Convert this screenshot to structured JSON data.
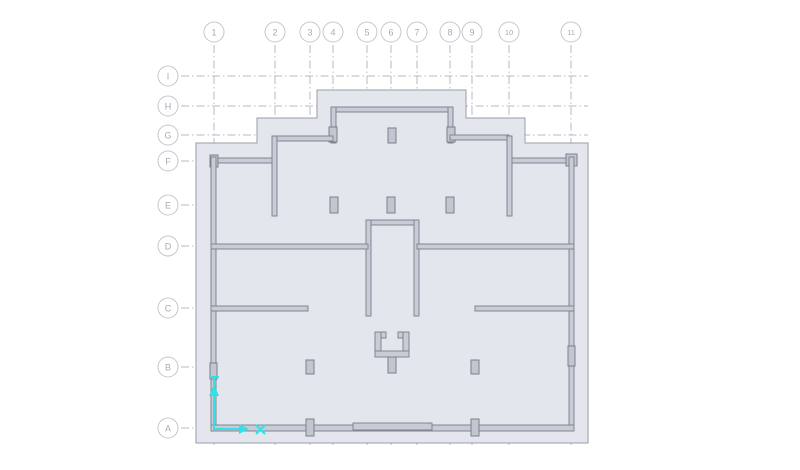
{
  "drawing": {
    "type": "structural-floor-plan",
    "grid": {
      "columns": [
        {
          "label": "1",
          "x": 214
        },
        {
          "label": "2",
          "x": 275
        },
        {
          "label": "3",
          "x": 310
        },
        {
          "label": "4",
          "x": 333
        },
        {
          "label": "5",
          "x": 367
        },
        {
          "label": "6",
          "x": 391
        },
        {
          "label": "7",
          "x": 417
        },
        {
          "label": "8",
          "x": 450
        },
        {
          "label": "9",
          "x": 472
        },
        {
          "label": "10",
          "x": 509
        },
        {
          "label": "11",
          "x": 571
        }
      ],
      "rows": [
        {
          "label": "I",
          "y": 76
        },
        {
          "label": "H",
          "y": 106
        },
        {
          "label": "G",
          "y": 135
        },
        {
          "label": "F",
          "y": 161
        },
        {
          "label": "E",
          "y": 205
        },
        {
          "label": "D",
          "y": 246
        },
        {
          "label": "C",
          "y": 308
        },
        {
          "label": "B",
          "y": 367
        },
        {
          "label": "A",
          "y": 428
        }
      ],
      "bubble_radius": 10,
      "column_bubble_y": 32,
      "row_bubble_x": 168,
      "v_line_top": 45,
      "v_line_bottom": 446,
      "h_line_left": 181,
      "h_line_right": 588
    },
    "colors": {
      "background": "#ffffff",
      "slab_fill": "#e4e6ed",
      "slab_edge": "#989daa",
      "wall_fill": "#c8ccd6",
      "wall_edge": "#80858f",
      "grid_line": "#b5b9c4",
      "bubble_edge": "#c4c7d0",
      "bubble_text": "#a8abb5",
      "highlight_cyan": "#35dfe8"
    },
    "annotation": {
      "name": "cyan-axis-marker",
      "description_glyphs": [
        "up-arrow",
        "right-arrow",
        "x-mark"
      ]
    }
  }
}
